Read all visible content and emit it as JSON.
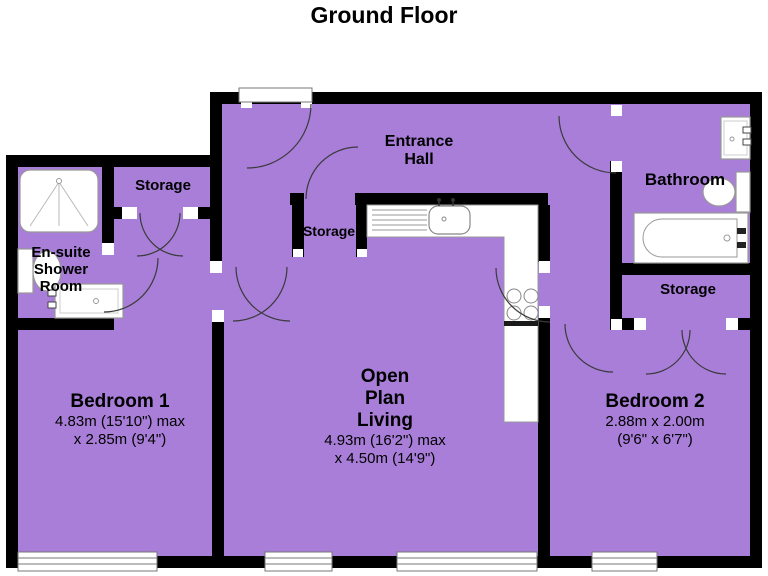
{
  "title": "Ground Floor",
  "colors": {
    "floor": "#a87ed8",
    "wall": "#000000",
    "fixture_outline": "#999999"
  },
  "rooms": {
    "entrance_hall": {
      "line1": "Entrance",
      "line2": "Hall"
    },
    "storage_top_left": {
      "label": "Storage"
    },
    "storage_middle": {
      "label": "Storage"
    },
    "storage_right": {
      "label": "Storage"
    },
    "bathroom": {
      "label": "Bathroom"
    },
    "ensuite": {
      "line1": "En-suite",
      "line2": "Shower",
      "line3": "Room"
    },
    "bedroom1": {
      "name": "Bedroom 1",
      "dim1": "4.83m (15'10\") max",
      "dim2": "x 2.85m (9'4\")"
    },
    "living": {
      "line1": "Open",
      "line2": "Plan",
      "line3": "Living",
      "dim1": "4.93m (16'2\") max",
      "dim2": "x 4.50m (14'9\")"
    },
    "bedroom2": {
      "name": "Bedroom 2",
      "dim1": "2.88m x 2.00m",
      "dim2": "(9'6\" x 6'7\")"
    }
  },
  "fixture_icons": [
    "shower-tray",
    "toilet",
    "wash-basin",
    "kitchen-sink",
    "drainer",
    "hob",
    "bathtub",
    "window",
    "door-arc",
    "door-jamb"
  ]
}
